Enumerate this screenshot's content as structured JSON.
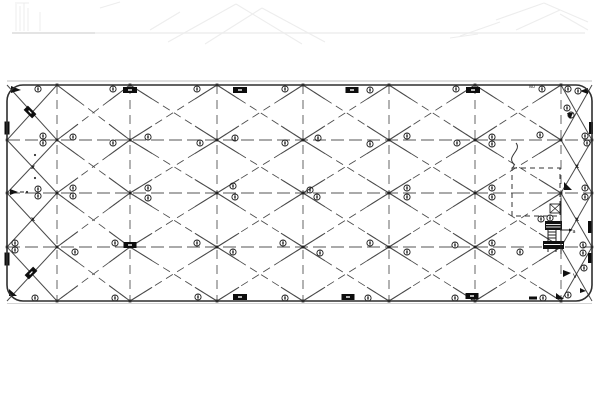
{
  "drawing": {
    "title": "bracing-framing-plan",
    "canvas": {
      "w": 600,
      "h": 400
    },
    "frame": {
      "x": 7,
      "y": 85,
      "w": 585,
      "h": 216,
      "r": 16,
      "stroke": "#2f2f2f"
    },
    "gray_lines": [
      {
        "x1": 7,
        "y1": 81,
        "x2": 592,
        "y2": 81,
        "c": "#c9c9c9",
        "w": 1.3
      },
      {
        "x1": 7,
        "y1": 303.5,
        "x2": 592,
        "y2": 303.5,
        "c": "#d4d4d4",
        "w": 1.0
      }
    ],
    "grid": {
      "cols": [
        7,
        57,
        130,
        217,
        303,
        389,
        475,
        561,
        592
      ],
      "rows": [
        85,
        140,
        193,
        247,
        301
      ],
      "inner_cols": [
        57,
        130,
        217,
        303,
        389,
        475,
        561
      ],
      "inner_rows": [
        140,
        193,
        247
      ],
      "line_color": "#555555",
      "diag_color": "#4a4a4a",
      "v_dash": "9 6",
      "h_dash": "13 5",
      "d_dash": "8 5",
      "solid_end_len": 26,
      "solid_threshold": 80
    },
    "circle_markers": [
      [
        38,
        89
      ],
      [
        113,
        89
      ],
      [
        197,
        89
      ],
      [
        285,
        89
      ],
      [
        370,
        90
      ],
      [
        456,
        89
      ],
      [
        542,
        89
      ],
      [
        568,
        89
      ],
      [
        578,
        91
      ],
      [
        43,
        136
      ],
      [
        43,
        143
      ],
      [
        73,
        137
      ],
      [
        113,
        143
      ],
      [
        148,
        137
      ],
      [
        200,
        143
      ],
      [
        235,
        138
      ],
      [
        285,
        143
      ],
      [
        318,
        138
      ],
      [
        370,
        144
      ],
      [
        407,
        136
      ],
      [
        457,
        143
      ],
      [
        492,
        137
      ],
      [
        492,
        144
      ],
      [
        540,
        135
      ],
      [
        585,
        136
      ],
      [
        587,
        143
      ],
      [
        567,
        108
      ],
      [
        571,
        115
      ],
      [
        38,
        189
      ],
      [
        38,
        196
      ],
      [
        73,
        188
      ],
      [
        73,
        196
      ],
      [
        148,
        188
      ],
      [
        148,
        198
      ],
      [
        233,
        186
      ],
      [
        235,
        197
      ],
      [
        310,
        190
      ],
      [
        317,
        197
      ],
      [
        407,
        188
      ],
      [
        407,
        197
      ],
      [
        492,
        188
      ],
      [
        492,
        197
      ],
      [
        541,
        219
      ],
      [
        550,
        218
      ],
      [
        585,
        188
      ],
      [
        585,
        197
      ],
      [
        15,
        243
      ],
      [
        15,
        250
      ],
      [
        75,
        252
      ],
      [
        115,
        243
      ],
      [
        197,
        243
      ],
      [
        233,
        252
      ],
      [
        283,
        243
      ],
      [
        320,
        253
      ],
      [
        370,
        243
      ],
      [
        407,
        252
      ],
      [
        455,
        245
      ],
      [
        492,
        243
      ],
      [
        492,
        252
      ],
      [
        520,
        252
      ],
      [
        583,
        245
      ],
      [
        583,
        253
      ],
      [
        35,
        298
      ],
      [
        115,
        298
      ],
      [
        198,
        297
      ],
      [
        285,
        298
      ],
      [
        368,
        298
      ],
      [
        455,
        298
      ],
      [
        474,
        298
      ],
      [
        543,
        298
      ],
      [
        568,
        295
      ],
      [
        584,
        268
      ]
    ],
    "tags": [
      {
        "x": 130,
        "y": 90,
        "w": 14,
        "h": 6
      },
      {
        "x": 240,
        "y": 90,
        "w": 14,
        "h": 6
      },
      {
        "x": 352,
        "y": 90,
        "w": 13,
        "h": 6
      },
      {
        "x": 473,
        "y": 90,
        "w": 14,
        "h": 6
      },
      {
        "x": 240,
        "y": 297,
        "w": 14,
        "h": 6
      },
      {
        "x": 348,
        "y": 297,
        "w": 13,
        "h": 6
      },
      {
        "x": 472,
        "y": 296,
        "w": 13,
        "h": 6
      },
      {
        "x": 130,
        "y": 245,
        "w": 13,
        "h": 6
      },
      {
        "x": 7,
        "y": 128,
        "w": 5,
        "h": 13
      },
      {
        "x": 7,
        "y": 259,
        "w": 5,
        "h": 13
      },
      {
        "x": 591,
        "y": 128,
        "w": 4,
        "h": 12
      },
      {
        "x": 590,
        "y": 227,
        "w": 4,
        "h": 12
      },
      {
        "x": 590,
        "y": 258,
        "w": 4,
        "h": 10
      },
      {
        "x": 533,
        "y": 298,
        "w": 8,
        "h": 3
      }
    ],
    "rotated_tags": [
      {
        "x": 30,
        "y": 112,
        "w": 12,
        "h": 6,
        "rot": 45
      },
      {
        "x": 31,
        "y": 273,
        "w": 12,
        "h": 6,
        "rot": -45
      }
    ],
    "texts": [
      {
        "x": 33,
        "y": 169,
        "s": "x",
        "size": 6.5,
        "bold": true
      },
      {
        "x": 33,
        "y": 221,
        "s": "x",
        "size": 6.5,
        "bold": true
      },
      {
        "x": 577,
        "y": 168,
        "s": "x",
        "size": 6.5,
        "bold": true
      },
      {
        "x": 577,
        "y": 221,
        "s": "x",
        "size": 6.5,
        "bold": true
      },
      {
        "x": 532,
        "y": 88,
        "s": "NO",
        "size": 4
      },
      {
        "x": 574,
        "y": 233,
        "s": "a",
        "size": 5
      },
      {
        "x": 575,
        "y": 278,
        "s": "V",
        "size": 6
      }
    ],
    "flags": [
      {
        "pts": "11,86 21,90 11,93"
      },
      {
        "pts": "588,88 580,91 588,94"
      },
      {
        "pts": "10,189 10,195 18,192"
      },
      {
        "pts": "9,289 17,296 9,296"
      },
      {
        "pts": "564,182 564,190 572,190"
      },
      {
        "pts": "563,270 563,277 571,273"
      },
      {
        "pts": "567,113 573,113 570,119"
      },
      {
        "pts": "580,288 586,291 580,293"
      },
      {
        "pts": "556,293 564,299 556,299"
      },
      {
        "pts": "569,228.5 573,230 569,231.5"
      }
    ],
    "dots": [
      [
        27,
        192
      ],
      [
        35,
        178
      ],
      [
        35,
        155
      ]
    ],
    "dash_marks": [
      [
        20,
        192,
        24,
        192
      ],
      [
        560,
        230,
        569,
        230
      ]
    ],
    "opening": {
      "x": 512,
      "y": 168,
      "w": 48,
      "h": 48,
      "dash": "5 4"
    },
    "curve_path": "M516,143 C522,150 507,156 513,163 C516,166 512,167 512,169",
    "ladder": {
      "box": {
        "x": 550,
        "y": 204,
        "w": 10,
        "h": 9
      },
      "black_rects": [
        {
          "x": 545,
          "y": 221,
          "w": 17,
          "h": 9
        },
        {
          "x": 543,
          "y": 241,
          "w": 21,
          "h": 8
        }
      ],
      "white_lines": [
        [
          546,
          224.5,
          561,
          224.5
        ],
        [
          546,
          227,
          561,
          227
        ],
        [
          544,
          244.5,
          563,
          244.5
        ]
      ],
      "lines": [
        [
          548,
          230,
          548,
          241
        ],
        [
          556,
          230,
          556,
          241
        ],
        [
          548,
          232,
          556,
          232
        ],
        [
          548,
          235,
          556,
          235
        ],
        [
          548,
          238,
          556,
          238
        ],
        [
          548,
          249,
          548,
          252
        ],
        [
          556,
          249,
          556,
          252
        ],
        [
          561,
          198,
          561,
          254
        ]
      ]
    },
    "ghost": {
      "color": "#ededed",
      "h_line": {
        "x1": 12,
        "y1": 33,
        "x2": 585,
        "y2": 33
      },
      "h_line2": {
        "x1": 12,
        "y1": 33,
        "x2": 95,
        "y2": 33,
        "c": "#dedede"
      },
      "lines": [
        [
          16,
          4,
          16,
          31
        ],
        [
          20,
          6,
          20,
          31
        ],
        [
          24,
          3,
          24,
          31
        ],
        [
          28,
          8,
          28,
          31
        ],
        [
          40,
          12,
          40,
          31
        ],
        [
          15,
          3,
          29,
          3
        ],
        [
          100,
          8,
          120,
          2
        ],
        [
          168,
          42,
          236,
          4
        ],
        [
          236,
          4,
          302,
          44
        ],
        [
          205,
          44,
          262,
          8
        ],
        [
          262,
          8,
          325,
          42
        ],
        [
          150,
          30,
          180,
          12
        ],
        [
          496,
          20,
          544,
          3
        ],
        [
          544,
          3,
          588,
          22
        ],
        [
          516,
          30,
          560,
          10
        ],
        [
          460,
          36,
          500,
          22
        ],
        [
          560,
          14,
          588,
          30
        ],
        [
          450,
          38,
          478,
          34
        ]
      ]
    }
  }
}
